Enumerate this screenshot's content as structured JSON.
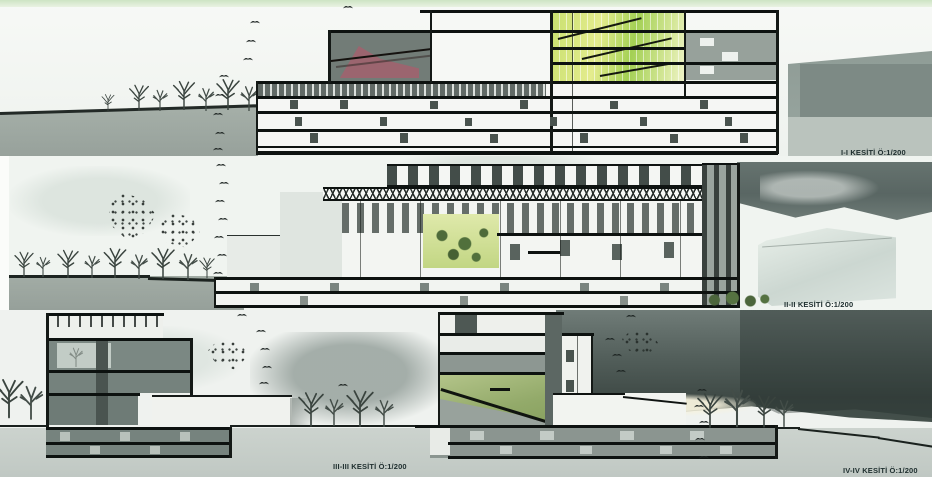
{
  "sections": [
    {
      "id": "I-I",
      "label": "I-I KESİTİ Ö:1/200"
    },
    {
      "id": "II-II",
      "label": "II-II KESİTİ Ö:1/200"
    },
    {
      "id": "III-III",
      "label": "III-III KESİTİ Ö:1/200"
    },
    {
      "id": "IV-IV",
      "label": "IV-IV KESİTİ Ö:1/200"
    }
  ],
  "icons": {
    "bird": "bird-icon",
    "tree": "tree-icon"
  },
  "colors": {
    "top_strip_green": "#cfe6c6",
    "sky": "#f2f5f1",
    "ground_gray": "#9fa9a2",
    "slab_black": "#0d1210",
    "atrium_green": "#a3d054",
    "atrium_yellow": "#e4ec8e",
    "auditorium_pink": "#a55f6d",
    "court_green": "#c2d683",
    "terrace_green": "#93aa6a",
    "dark_storm_cloud": "#3f4a46",
    "glazing_dark": "#76837e"
  }
}
